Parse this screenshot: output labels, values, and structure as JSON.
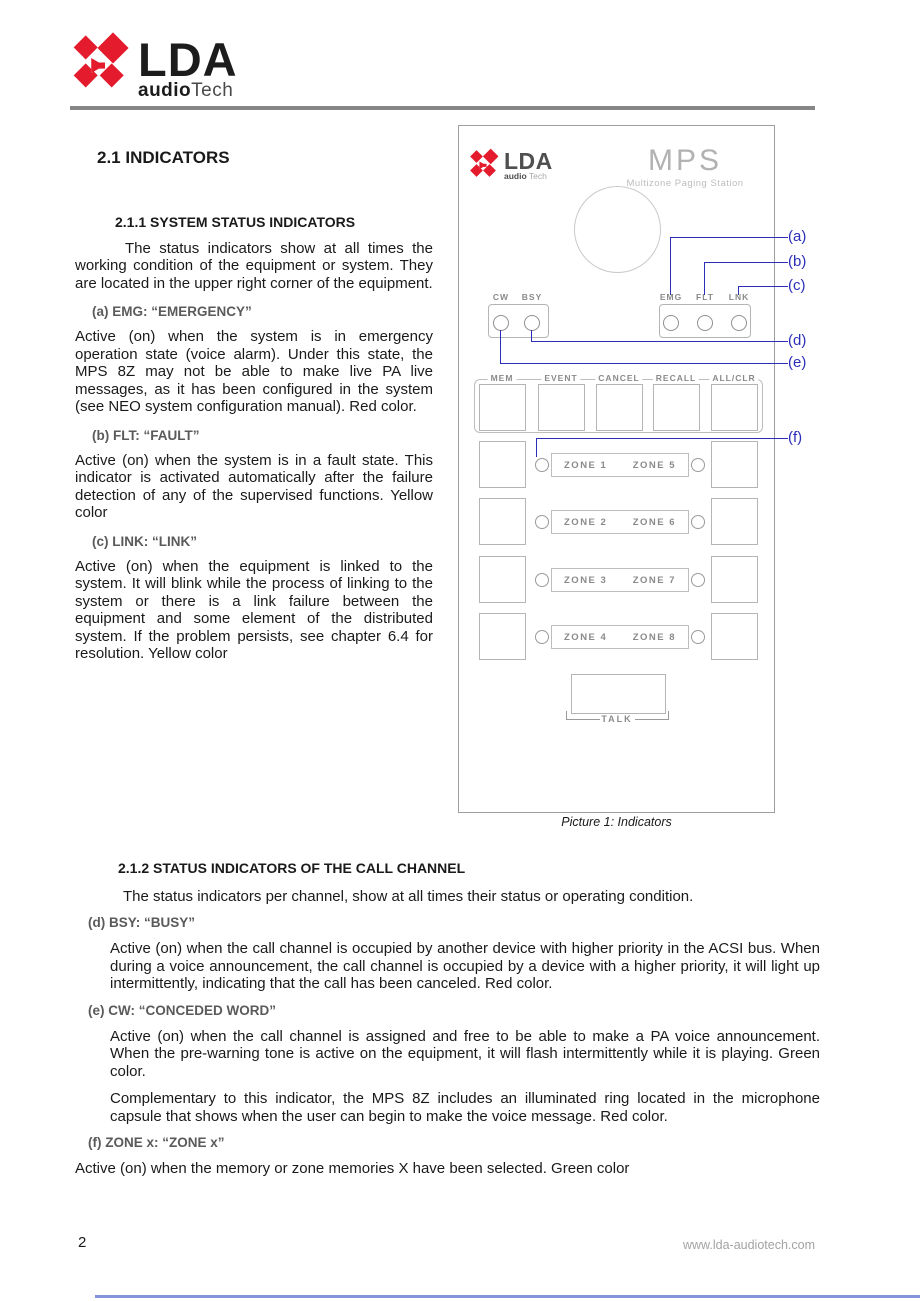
{
  "header": {
    "brand": {
      "name": "LDA",
      "audio": "audio",
      "tech": "Tech"
    }
  },
  "doc": {
    "section1": {
      "title": "2.1  INDICATORS",
      "subsection_title": "2.1.1  SYSTEM STATUS INDICATORS",
      "intro": "The status indicators show at all times the working condition of the equipment or system. They are located in the upper right corner of the equipment.",
      "items": [
        {
          "heading": "(a) EMG: “EMERGENCY”",
          "body": "Active (on) when the system is in emergency operation state (voice alarm). Under this state, the MPS 8Z may not be able to make live PA live messages, as it has been configured in the system (see NEO system configuration manual). Red color."
        },
        {
          "heading": "(b) FLT: “FAULT”",
          "body": "Active (on) when the system is in a fault state. This indicator is activated automatically after the failure detection of any of the supervised functions. Yellow color"
        },
        {
          "heading": "(c) LINK: “LINK”",
          "body": "Active (on) when the equipment is linked to the system. It will blink while the process of linking to the system or there is a link failure between the equipment and some element of the distributed system. If the problem persists, see chapter 6.4 for resolution. Yellow color"
        }
      ]
    },
    "section2": {
      "title": "2.1.2  STATUS INDICATORS OF THE CALL CHANNEL",
      "intro": "The status indicators per channel, show at all times their status or operating condition.",
      "items": [
        {
          "heading": "(d) BSY: “BUSY”",
          "p1": "Active (on) when the call channel is occupied by another device with higher priority in the ACSI bus. When during a voice announcement, the call channel is occupied by a device with a higher priority, it will light up intermittently, indicating that the call has been canceled. Red color."
        },
        {
          "heading": "(e) CW: “CONCEDED WORD”",
          "p1": "Active (on) when the call channel is assigned and free to be able to make a PA voice announcement. When the pre-warning tone is active on the equipment, it will flash intermittently while it is playing. Green color.",
          "p2": "Complementary to this indicator, the MPS 8Z includes an illuminated ring located in the microphone capsule that shows when the user can begin to make the voice message. Red color."
        },
        {
          "heading": "(f) ZONE x: “ZONE x”"
        }
      ],
      "closing": "Active (on) when the memory or zone memories X have been selected. Green color"
    }
  },
  "figure": {
    "caption": "Picture 1: Indicators",
    "callouts": [
      "(a)",
      "(b)",
      "(c)",
      "(d)",
      "(e)",
      "(f)"
    ],
    "device": {
      "brand": {
        "name": "LDA",
        "audio": "audio",
        "tech": "Tech"
      },
      "model": "MPS",
      "model_subtitle": "Multizone Paging Station",
      "channel_leds": [
        "CW",
        "BSY"
      ],
      "system_leds": [
        "EMG",
        "FLT",
        "LNK"
      ],
      "buttons": [
        "MEM",
        "EVENT",
        "CANCEL",
        "RECALL",
        "ALL/CLR"
      ],
      "zones": [
        {
          "left": "ZONE 1",
          "right": "ZONE 5"
        },
        {
          "left": "ZONE 2",
          "right": "ZONE 6"
        },
        {
          "left": "ZONE 3",
          "right": "ZONE 7"
        },
        {
          "left": "ZONE 4",
          "right": "ZONE 8"
        }
      ],
      "talk": "TALK"
    }
  },
  "footer": {
    "page_number": "2",
    "website": "www.lda-audiotech.com"
  },
  "colors": {
    "brand_red": "#e31b2d",
    "callout_blue": "#2a2eb8",
    "header_rule_gray": "#868686",
    "footer_line_blue": "#8593d8"
  }
}
